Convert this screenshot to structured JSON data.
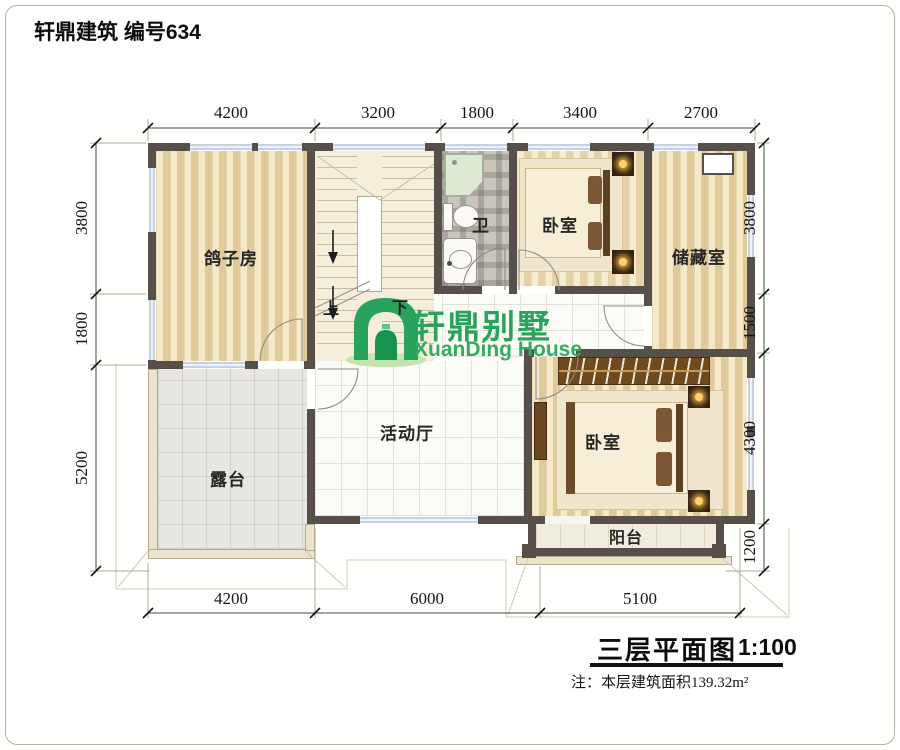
{
  "header": {
    "title": "轩鼎建筑 编号634"
  },
  "logo": {
    "cn": "轩鼎别墅",
    "en": "XuanDing House"
  },
  "rooms": {
    "pigeon": "鸽子房",
    "bedroom1": "卧室",
    "storage": "储藏室",
    "bath": "卫",
    "hall": "活动厅",
    "bedroom2": "卧室",
    "terrace": "露台",
    "balcony": "阳台"
  },
  "stairs": {
    "up": "上",
    "down": "下"
  },
  "dims": {
    "top": [
      "4200",
      "3200",
      "1800",
      "3400",
      "2700"
    ],
    "bottom": [
      "4200",
      "6000",
      "5100"
    ],
    "left": [
      "3800",
      "1800",
      "5200"
    ],
    "right": [
      "3800",
      "1500",
      "4300",
      "1200"
    ]
  },
  "titleblock": {
    "name": "三层平面图",
    "scale": "1:100",
    "note": "注：本层建筑面积139.32m²"
  },
  "colors": {
    "wall": "#57504a",
    "window": "#dce7f3",
    "logo_green": "#28a35c",
    "wood": "#e9d7ab"
  }
}
